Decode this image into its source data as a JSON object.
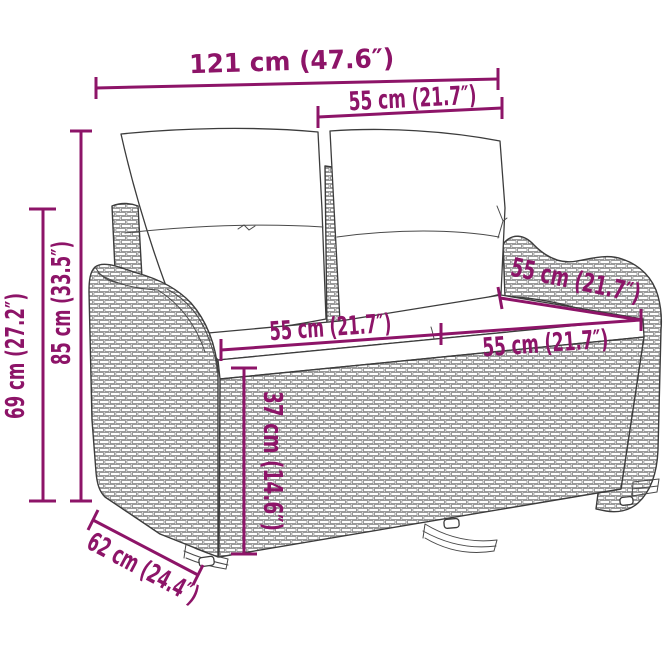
{
  "image": {
    "kind": "product-dimension-diagram",
    "description": "2-seat poly rattan garden bench with back and seat cushions, line drawing with dimension annotations",
    "background": "#ffffff"
  },
  "colors": {
    "dimension_accent": "#8D1468",
    "line_art": "#3c3c3c",
    "weave": "#6f6f6f"
  },
  "dimensions": [
    {
      "id": "overall-width",
      "label": "121 cm (47.6″)"
    },
    {
      "id": "backrest-section-width",
      "label": "55 cm (21.7″)"
    },
    {
      "id": "overall-height",
      "label": "85 cm (33.5″)"
    },
    {
      "id": "armrest-height",
      "label": "69 cm (27.2″)"
    },
    {
      "id": "seat-width-left",
      "label": "55 cm (21.7″)"
    },
    {
      "id": "seat-width-right",
      "label": "55 cm (21.7″)"
    },
    {
      "id": "seat-depth",
      "label": "55 cm (21.7″)"
    },
    {
      "id": "seat-height",
      "label": "37 cm (14.6″)"
    },
    {
      "id": "overall-depth",
      "label": "62 cm (24.4″)"
    }
  ]
}
